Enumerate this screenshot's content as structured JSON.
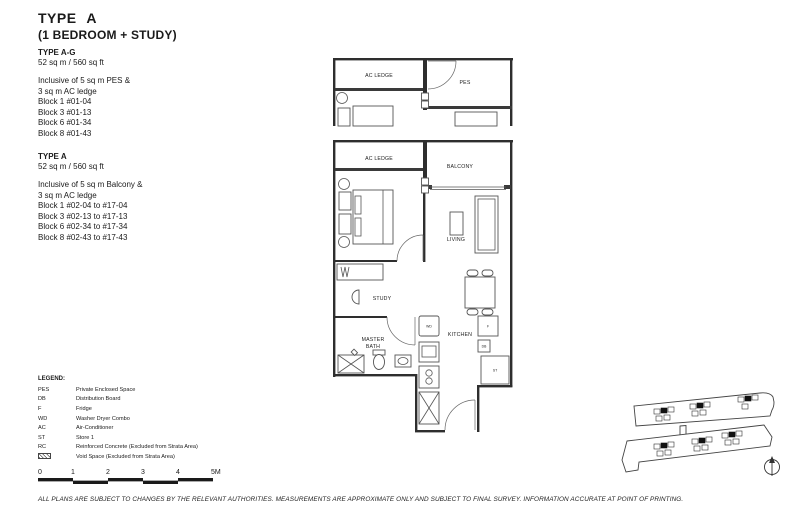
{
  "header": {
    "title": "TYPE A",
    "subtitle": "(1 BEDROOM + STUDY)"
  },
  "variants": [
    {
      "name": "TYPE A-G",
      "area": "52 sq m / 560 sq ft",
      "inclusive": [
        "Inclusive of 5 sq m PES &",
        "3 sq m AC ledge"
      ],
      "blocks": [
        "Block 1 #01-04",
        "Block 3 #01-13",
        "Block 6 #01-34",
        "Block 8 #01-43"
      ]
    },
    {
      "name": "TYPE A",
      "area": "52 sq m / 560 sq ft",
      "inclusive": [
        "Inclusive of 5 sq m Balcony &",
        "3 sq m AC ledge"
      ],
      "blocks": [
        "Block 1 #02-04 to #17-04",
        "Block 3 #02-13 to #17-13",
        "Block 6 #02-34 to #17-34",
        "Block 8 #02-43 to #17-43"
      ]
    }
  ],
  "legend": {
    "title": "LEGEND:",
    "items": [
      {
        "abbr": "PES",
        "label": "Private Enclosed Space"
      },
      {
        "abbr": "DB",
        "label": "Distribution Board"
      },
      {
        "abbr": "F",
        "label": "Fridge"
      },
      {
        "abbr": "WD",
        "label": "Washer Dryer Combo"
      },
      {
        "abbr": "AC",
        "label": "Air-Conditioner"
      },
      {
        "abbr": "ST",
        "label": "Store 1"
      },
      {
        "abbr": "RC",
        "label": "Reinforced Concrete (Excluded from Strata Area)"
      },
      {
        "abbr": "",
        "label": "Void Space (Excluded from Strata Area)"
      }
    ]
  },
  "scale_bar": {
    "ticks": [
      "0",
      "1",
      "2",
      "3",
      "4",
      "5M"
    ]
  },
  "floor_plan": {
    "upper_fragment": {
      "ac_ledge": "AC LEDGE",
      "pes": "PES"
    },
    "rooms": {
      "ac_ledge": "AC LEDGE",
      "balcony": "BALCONY",
      "master_bedroom_line1": "MASTER",
      "master_bedroom_line2": "BEDROOM",
      "living": "LIVING",
      "study": "STUDY",
      "dining": "DINING",
      "master_bath_line1": "MASTER",
      "master_bath_line2": "BATH",
      "kitchen": "KITCHEN"
    },
    "fixtures": {
      "wd": "WD",
      "f": "F",
      "db": "DB",
      "st": "ST"
    }
  },
  "footer": {
    "disclaimer": "ALL PLANS ARE SUBJECT TO CHANGES BY THE RELEVANT AUTHORITIES. MEASUREMENTS ARE APPROXIMATE ONLY AND SUBJECT TO FINAL SURVEY. INFORMATION ACCURATE AT POINT OF PRINTING."
  },
  "colors": {
    "line": "#2e2e2e",
    "text": "#1a1a1a",
    "background": "#ffffff"
  }
}
